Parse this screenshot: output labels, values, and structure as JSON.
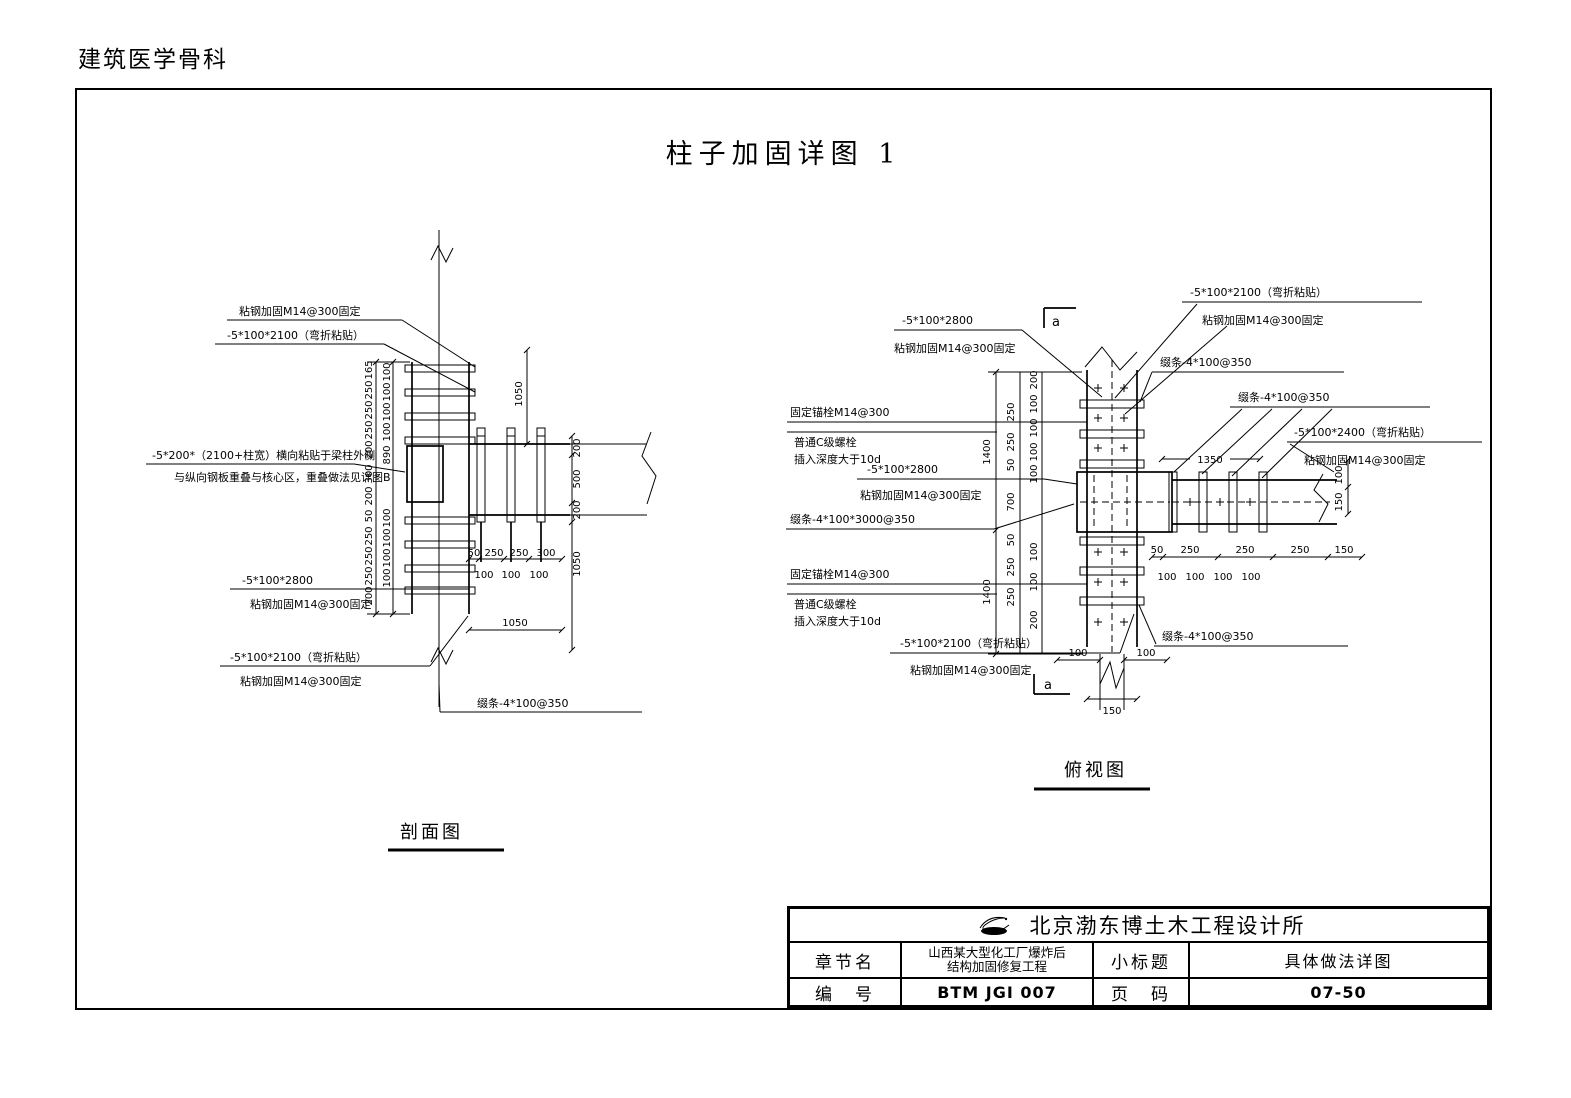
{
  "page": {
    "header": "建筑医学骨科",
    "title": "柱子加固详图 1",
    "colors": {
      "ink": "#000000",
      "paper": "#ffffff"
    }
  },
  "section_view": {
    "caption": "剖面图",
    "labels": {
      "glue_fix": "粘钢加固M14@300固定",
      "bend_2100": "-5*100*2100（弯折粘贴）",
      "plate_200": "-5*200*（2100+柱宽）横向粘贴于梁柱外侧",
      "plate_200_note": "与纵向钢板重叠与核心区，重叠做法见详图B",
      "plate_2800": "-5*100*2800",
      "batten": "缀条-4*100@350"
    },
    "dims": {
      "left_outer": [
        "165",
        "250",
        "250",
        "250",
        "200",
        "300",
        "200",
        "50",
        "250",
        "250",
        "250",
        "200"
      ],
      "left_inner": [
        "100",
        "100",
        "100",
        "100",
        "890",
        "100",
        "100",
        "100",
        "100"
      ],
      "top_right": "1050",
      "beam_right": [
        "200",
        "500",
        "200"
      ],
      "below_beam_right": "1050",
      "bottom_chain": [
        "50",
        "250",
        "250",
        "300"
      ],
      "bottom_inner": [
        "100",
        "100",
        "100"
      ],
      "bottom_total": "1050"
    }
  },
  "plan_view": {
    "caption": "俯视图",
    "section_marker": "a",
    "labels": {
      "plate_2800": "-5*100*2800",
      "glue_fix": "粘钢加固M14@300固定",
      "bend_2100": "-5*100*2100（弯折粘贴）",
      "batten_350": "缀条-4*100@350",
      "bend_2400": "-5*100*2400（弯折粘贴）",
      "anchor": "固定锚栓M14@300",
      "bolt": "普通C级螺栓",
      "bolt_depth": "插入深度大于10d",
      "batten_3000": "缀条-4*100*3000@350"
    },
    "dims": {
      "left_outer": [
        "1400",
        "1400"
      ],
      "left_mid": [
        "250",
        "250",
        "50",
        "700",
        "50",
        "250",
        "250"
      ],
      "left_inner": [
        "200",
        "100",
        "100",
        "100",
        "100",
        "100",
        "100",
        "200"
      ],
      "beam_top": "1350",
      "beam_right": [
        "100",
        "150"
      ],
      "bottom_chain": [
        "50",
        "250",
        "250",
        "250",
        "150"
      ],
      "bottom_inner": [
        "100",
        "100",
        "100",
        "100"
      ],
      "foot": [
        "100",
        "100"
      ],
      "foot_width": "150"
    }
  },
  "title_block": {
    "company": "北京渤东博土木工程设计所",
    "chapter_label": "章节名",
    "chapter_value_line1": "山西某大型化工厂爆炸后",
    "chapter_value_line2": "结构加固修复工程",
    "subtitle_label": "小标题",
    "subtitle_value": "具体做法详图",
    "number_label": "编　号",
    "number_value": "BTM JGI 007",
    "page_label": "页　码",
    "page_value": "07-50"
  }
}
